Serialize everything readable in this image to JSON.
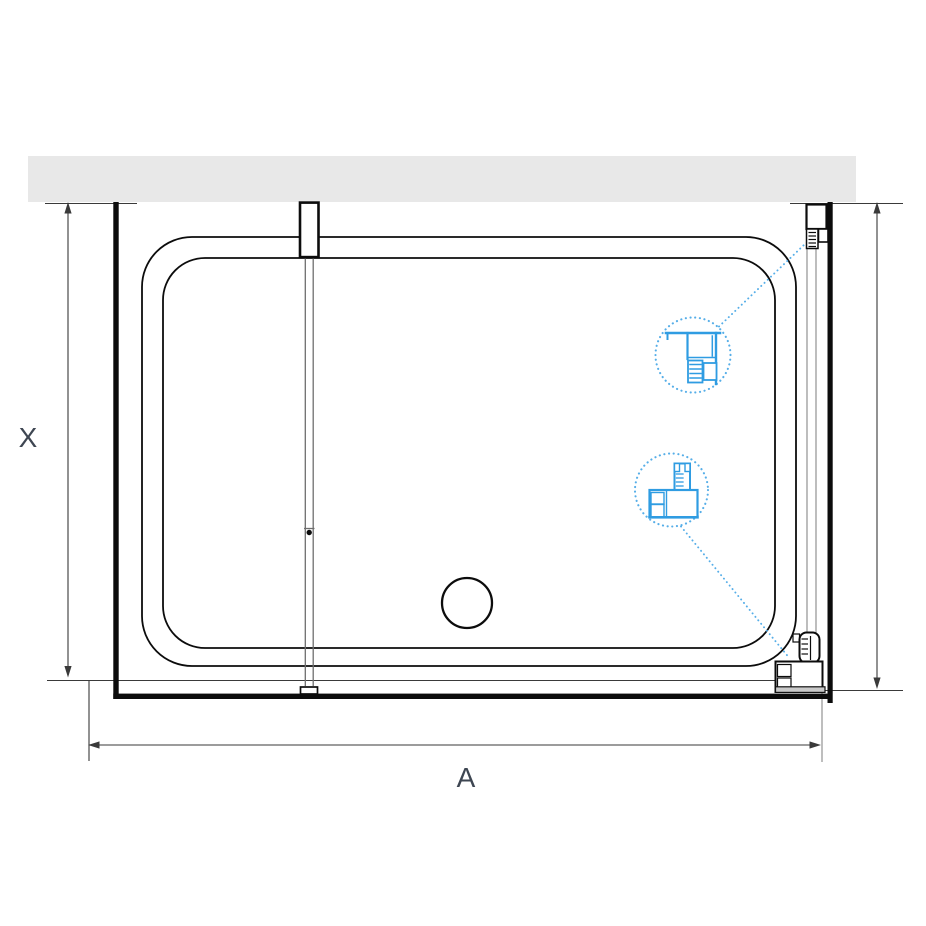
{
  "diagram": {
    "kind": "shower-enclosure-top-view-plan",
    "labels": {
      "x": "X",
      "a": "A"
    },
    "icons": {
      "upper_callout": "wall-profile-detail-icon",
      "lower_callout": "floor-bracket-detail-icon"
    }
  },
  "colors": {
    "background": "#ffffff",
    "wall_fill": "#e8e8e8",
    "line": "#0c0c0c",
    "dim_line": "#3a3a3a",
    "soft_line": "#9a9a9a",
    "glass_line": "#6e6e6e",
    "detail_blue": "#2f9ce2",
    "callout_blue": "#56aee8",
    "label_color": "#3e4652"
  }
}
